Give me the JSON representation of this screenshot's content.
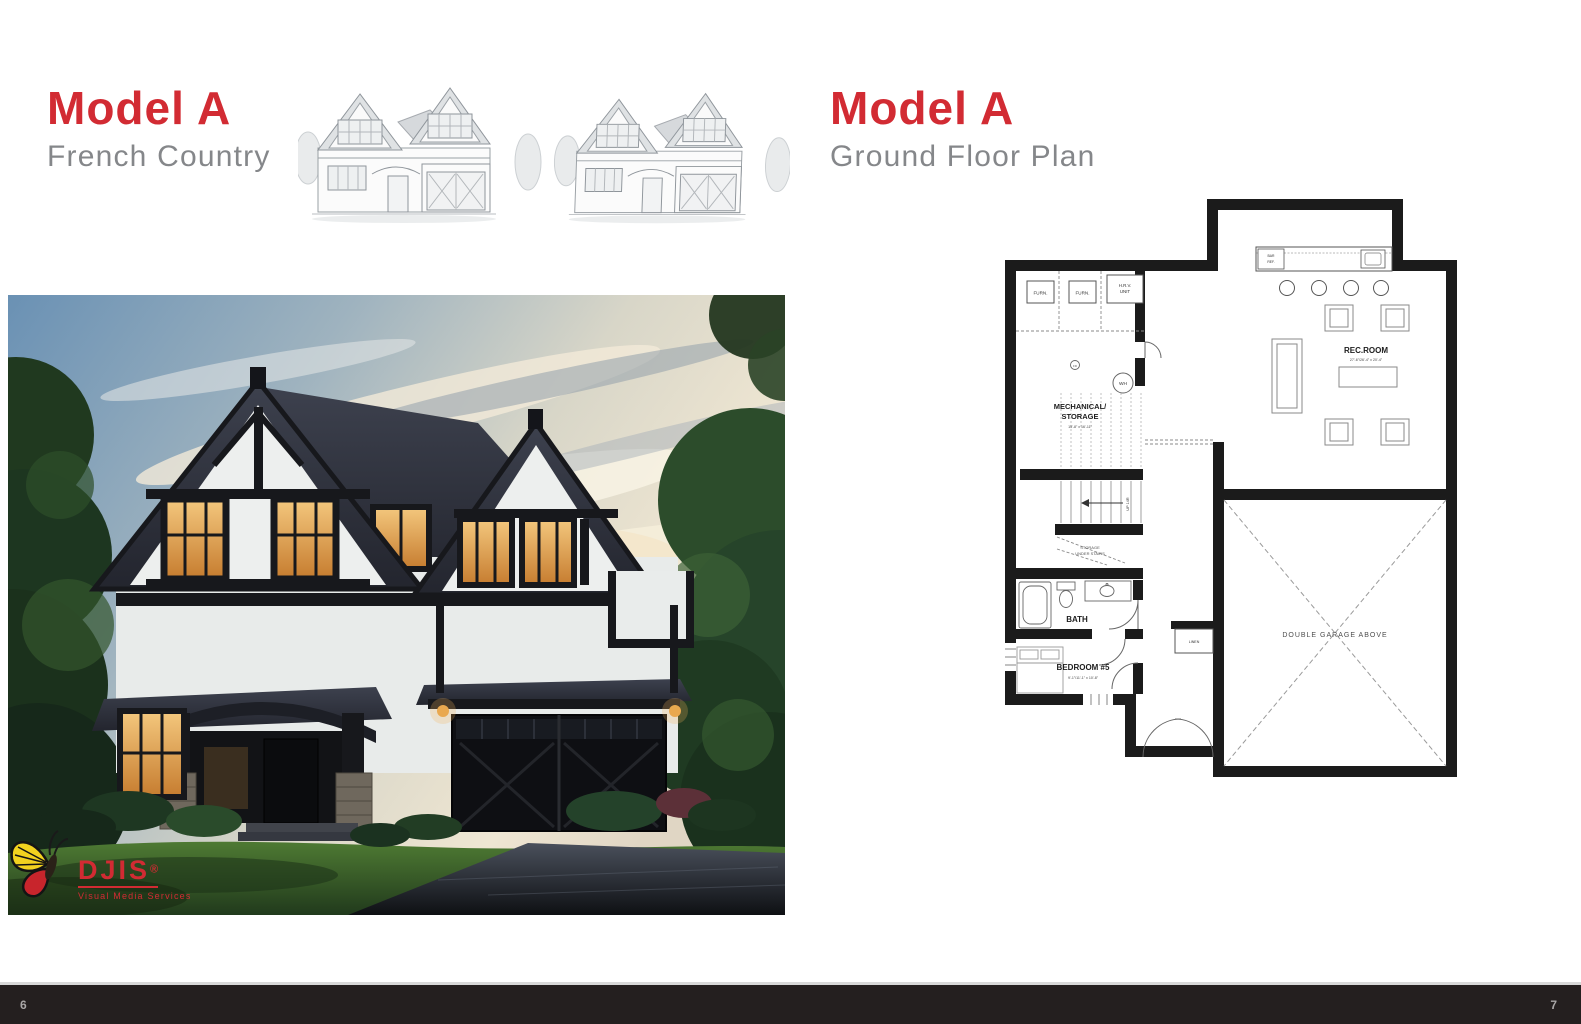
{
  "page": {
    "left": {
      "title": "Model A",
      "subtitle": "French Country",
      "page_number": "6"
    },
    "right": {
      "title": "Model A",
      "subtitle": "Ground Floor Plan",
      "page_number": "7"
    }
  },
  "logo": {
    "brand": "DJIS",
    "registered": "®",
    "tagline": "Visual Media Services"
  },
  "colors": {
    "accent_red": "#d22b33",
    "subtitle_gray": "#85878a",
    "footer_bar": "#241f1f",
    "wall_black": "#1b1b1b"
  },
  "floor_plan": {
    "labels": {
      "furnace_1": "FURN.",
      "furnace_2": "FURN.",
      "hrv_line1": "H.R.V.",
      "hrv_line2": "UNIT",
      "floor_drain": "FD",
      "water_heater": "WH",
      "mechanical_line1": "MECHANICAL/",
      "mechanical_line2": "STORAGE",
      "mechanical_dims": "15'-8\" x 16'-11\"",
      "bar_line1": "BAR",
      "bar_line2": "REF.",
      "rec_room": "REC.ROOM",
      "rec_room_dims": "27'-6\"/26'-4\" x 20'-4\"",
      "stairs_up": "UP 14R",
      "storage_line1": "STORAGE",
      "storage_line2": "UNDER STAIRS",
      "bath": "BATH",
      "linen": "LINEN",
      "bedroom": "BEDROOM #5",
      "bedroom_dims": "9'-1\"/11'-1\" x 10'-8\"",
      "garage": "DOUBLE GARAGE ABOVE"
    }
  }
}
